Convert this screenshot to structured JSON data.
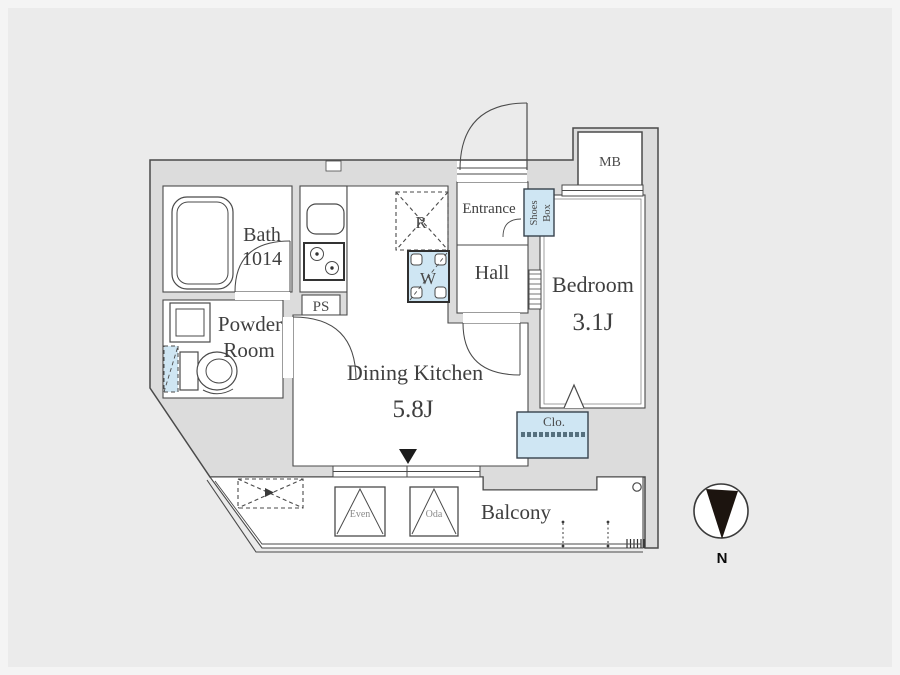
{
  "labels": {
    "bath_line1": "Bath",
    "bath_line2": "1014",
    "powder_line1": "Powder",
    "powder_line2": "Room",
    "pipe_space": "PS",
    "dining_kitchen": "Dining Kitchen",
    "dining_kitchen_size": "5.8J",
    "hall": "Hall",
    "entrance": "Entrance",
    "shoes_box_line1": "Shoes",
    "shoes_box_line2": "Box",
    "refrigerator_space": "R",
    "washer_space": "W",
    "meter_box": "MB",
    "bedroom": "Bedroom",
    "bedroom_size": "3.1J",
    "closet": "Clo.",
    "balcony": "Balcony",
    "balcony_unit_left": "Even",
    "balcony_unit_right": "Oda",
    "compass_north": "N"
  },
  "colors": {
    "background": "#ebebeb",
    "wall_fill": "#dcdcdc",
    "line": "#4a4a4a",
    "fixture_blue": "#cfe6f3",
    "text": "#3f3f3f"
  }
}
